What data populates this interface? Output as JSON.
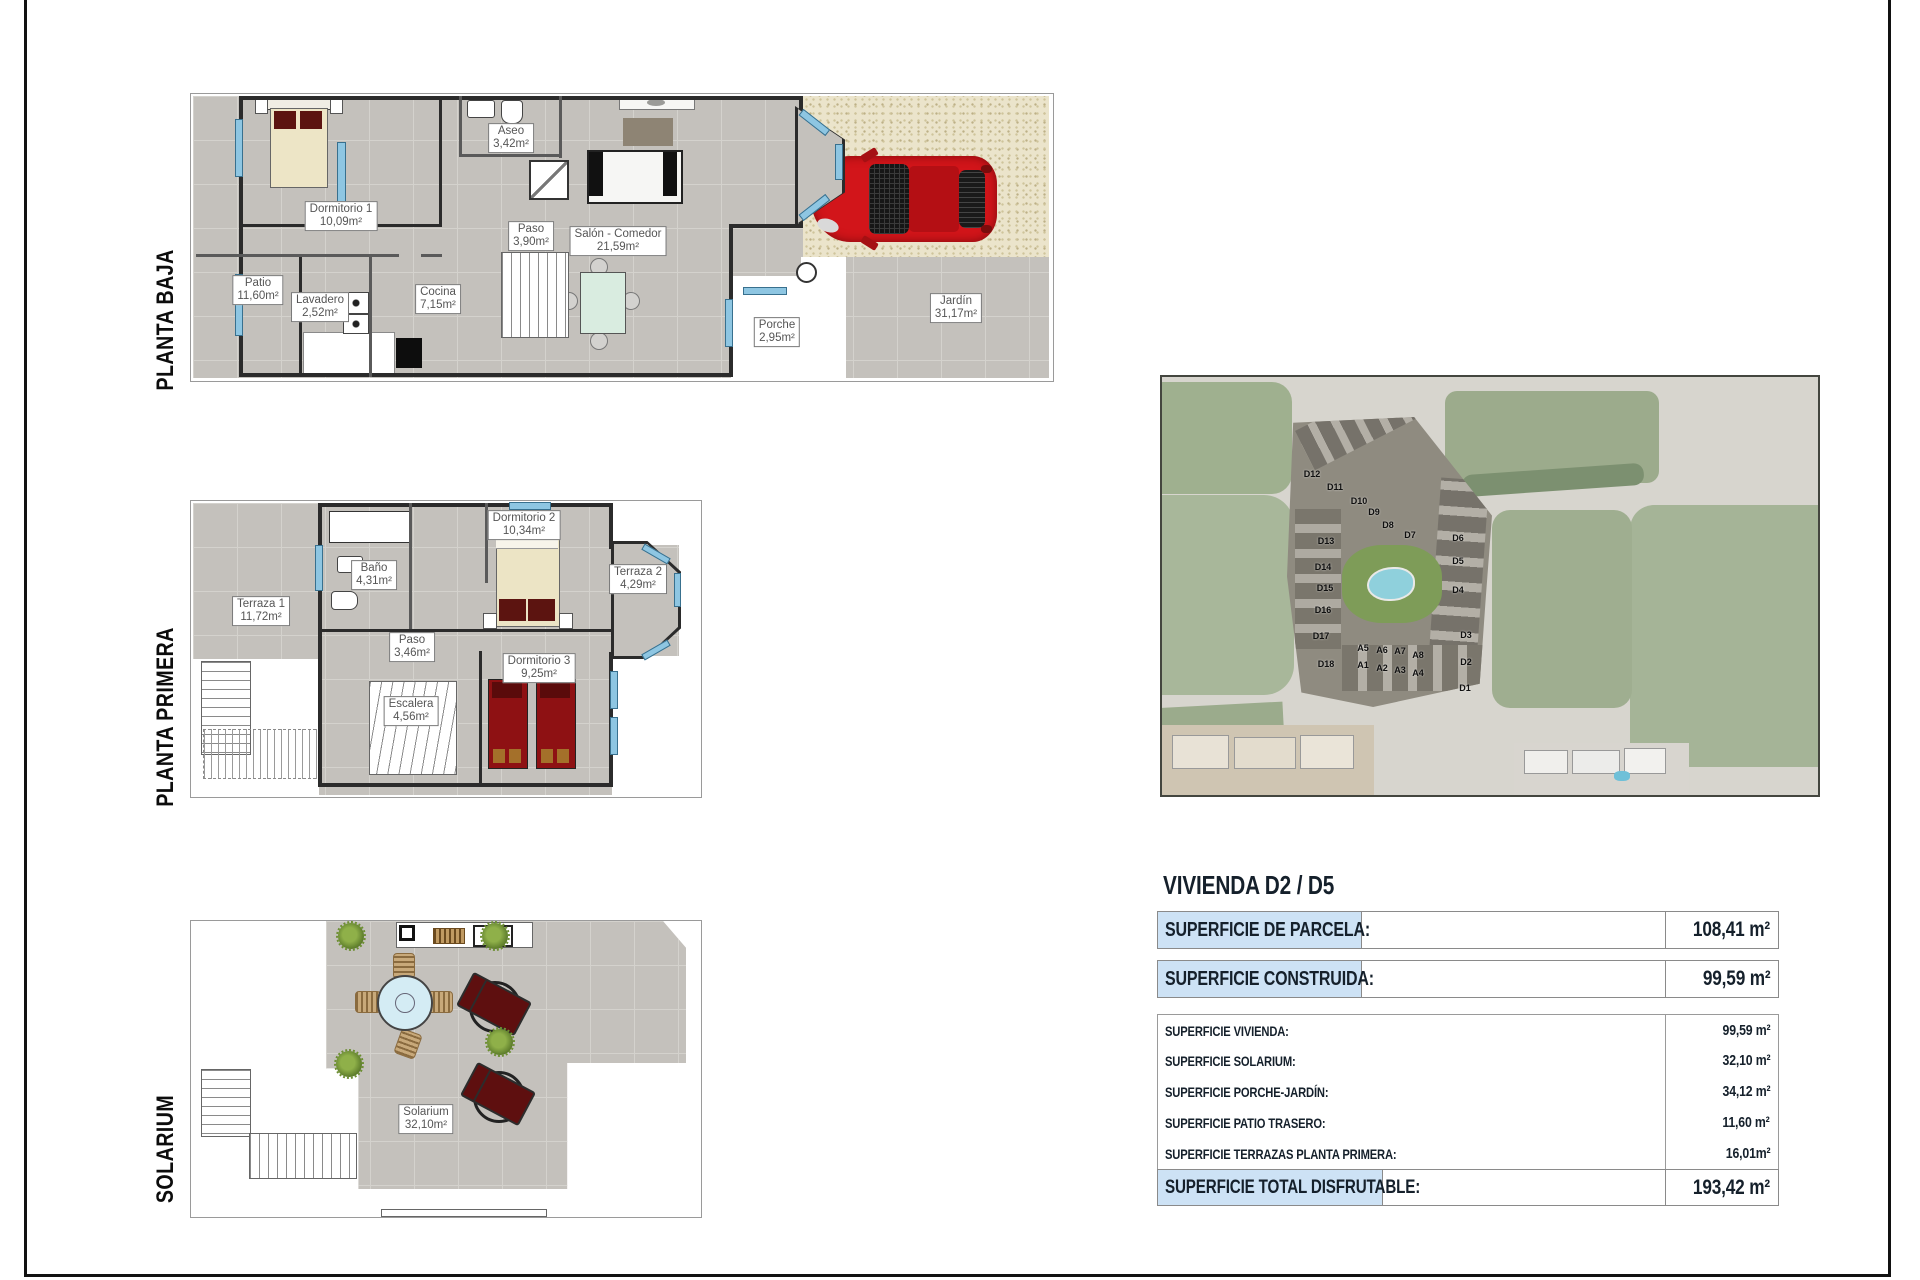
{
  "plans": {
    "baja": {
      "label": "PLANTA BAJA",
      "rooms": {
        "dormitorio1": {
          "name": "Dormitorio 1",
          "area": "10,09m²"
        },
        "aseo": {
          "name": "Aseo",
          "area": "3,42m²"
        },
        "paso": {
          "name": "Paso",
          "area": "3,90m²"
        },
        "salon": {
          "name": "Salón - Comedor",
          "area": "21,59m²"
        },
        "patio": {
          "name": "Patio",
          "area": "11,60m²"
        },
        "lavadero": {
          "name": "Lavadero",
          "area": "2,52m²"
        },
        "cocina": {
          "name": "Cocina",
          "area": "7,15m²"
        },
        "porche": {
          "name": "Porche",
          "area": "2,95m²"
        },
        "jardin": {
          "name": "Jardín",
          "area": "31,17m²"
        }
      }
    },
    "primera": {
      "label": "PLANTA PRIMERA",
      "rooms": {
        "terraza1": {
          "name": "Terraza 1",
          "area": "11,72m²"
        },
        "banyo": {
          "name": "Baño",
          "area": "4,31m²"
        },
        "dormitorio2": {
          "name": "Dormitorio 2",
          "area": "10,34m²"
        },
        "terraza2": {
          "name": "Terraza 2",
          "area": "4,29m²"
        },
        "paso": {
          "name": "Paso",
          "area": "3,46m²"
        },
        "escalera": {
          "name": "Escalera",
          "area": "4,56m²"
        },
        "dormitorio3": {
          "name": "Dormitorio 3",
          "area": "9,25m²"
        }
      }
    },
    "solarium": {
      "label": "SOLARIUM",
      "rooms": {
        "solarium": {
          "name": "Solarium",
          "area": "32,10m²"
        }
      }
    }
  },
  "site_map": {
    "building_labels": [
      {
        "t": "D12",
        "x": 150,
        "y": 97
      },
      {
        "t": "D11",
        "x": 173,
        "y": 110
      },
      {
        "t": "D10",
        "x": 197,
        "y": 124
      },
      {
        "t": "D9",
        "x": 212,
        "y": 135
      },
      {
        "t": "D8",
        "x": 226,
        "y": 148
      },
      {
        "t": "D7",
        "x": 248,
        "y": 158
      },
      {
        "t": "D13",
        "x": 164,
        "y": 164
      },
      {
        "t": "D14",
        "x": 161,
        "y": 190
      },
      {
        "t": "D15",
        "x": 163,
        "y": 211
      },
      {
        "t": "D16",
        "x": 161,
        "y": 233
      },
      {
        "t": "D17",
        "x": 159,
        "y": 259
      },
      {
        "t": "D18",
        "x": 164,
        "y": 287
      },
      {
        "t": "D6",
        "x": 296,
        "y": 161
      },
      {
        "t": "D5",
        "x": 296,
        "y": 184
      },
      {
        "t": "D4",
        "x": 296,
        "y": 213
      },
      {
        "t": "D3",
        "x": 304,
        "y": 258
      },
      {
        "t": "D2",
        "x": 304,
        "y": 285
      },
      {
        "t": "D1",
        "x": 303,
        "y": 311
      },
      {
        "t": "A5",
        "x": 201,
        "y": 271
      },
      {
        "t": "A6",
        "x": 220,
        "y": 273
      },
      {
        "t": "A7",
        "x": 238,
        "y": 274
      },
      {
        "t": "A8",
        "x": 256,
        "y": 278
      },
      {
        "t": "A1",
        "x": 201,
        "y": 288
      },
      {
        "t": "A2",
        "x": 220,
        "y": 291
      },
      {
        "t": "A3",
        "x": 238,
        "y": 293
      },
      {
        "t": "A4",
        "x": 256,
        "y": 296
      }
    ]
  },
  "summary": {
    "title": "VIVIENDA D2 / D5",
    "parcela": {
      "label": "SUPERFICIE DE PARCELA:",
      "value": "108,41 m²"
    },
    "construida": {
      "label": "SUPERFICIE CONSTRUIDA:",
      "value": "99,59 m²"
    },
    "detail_rows": [
      {
        "label": "SUPERFICIE VIVIENDA:",
        "value": "99,59 m²"
      },
      {
        "label": "SUPERFICIE SOLARIUM:",
        "value": "32,10 m²"
      },
      {
        "label": "SUPERFICIE PORCHE-JARDÍN:",
        "value": "34,12 m²"
      },
      {
        "label": "SUPERFICIE PATIO TRASERO:",
        "value": "11,60 m²"
      },
      {
        "label": "SUPERFICIE TERRAZAS PLANTA PRIMERA:",
        "value": "16,01m²"
      }
    ],
    "total": {
      "label": "SUPERFICIE TOTAL DISFRUTABLE:",
      "value": "193,42 m²"
    }
  },
  "colors": {
    "highlight_blue": "#cde2f5",
    "wall": "#2b2b2b",
    "window_blue": "#8ec6e2",
    "car_red": "#d2151a",
    "tile_gray": "#c4c1bc"
  }
}
